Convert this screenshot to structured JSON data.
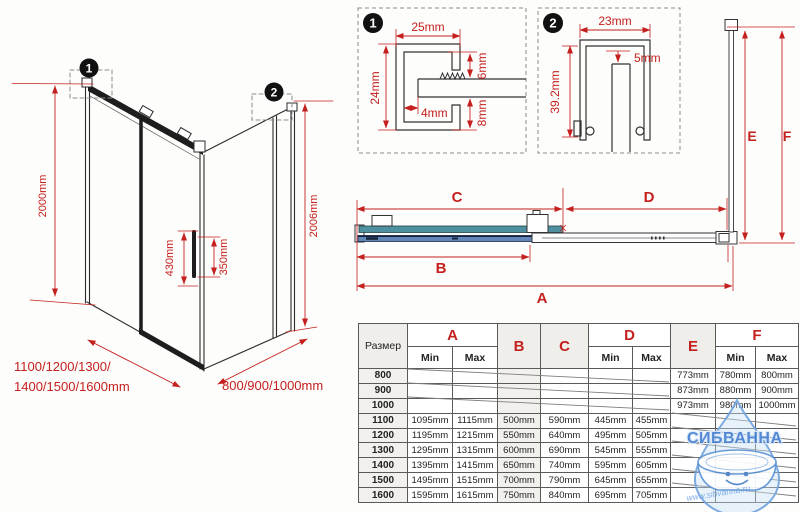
{
  "colors": {
    "dim_red": "#c4201d",
    "door_teal": "#4e8fa0",
    "panel_blue": "#6286b8",
    "edge_navy": "#1e2f4a",
    "watermark_blue": "#4780d2"
  },
  "iso": {
    "badge1": "1",
    "badge2": "2",
    "height_left": "2000mm",
    "height_right": "2006mm",
    "handle_outer": "430mm",
    "handle_inner": "350mm",
    "width_line1": "1100/1200/1300/",
    "width_line2": "1400/1500/1600mm",
    "depth": "800/900/1000mm"
  },
  "detail1": {
    "badge": "1",
    "width": "25mm",
    "height": "24mm",
    "top_gap": "6mm",
    "inset": "4mm",
    "bottom_gap": "8mm"
  },
  "detail2": {
    "badge": "2",
    "width": "23mm",
    "gap": "5mm",
    "height": "39.2mm"
  },
  "topview": {
    "a": "A",
    "b": "B",
    "c": "C",
    "d": "D",
    "e": "E",
    "f": "F"
  },
  "table": {
    "size_header": "Размер",
    "min": "Min",
    "max": "Max",
    "col_a": "A",
    "col_b": "B",
    "col_c": "C",
    "col_d": "D",
    "col_e": "E",
    "col_f": "F",
    "rows": [
      {
        "size": "800",
        "a_min": "",
        "a_max": "",
        "b": "",
        "c": "",
        "d_min": "",
        "d_max": "",
        "e": "773mm",
        "f_min": "780mm",
        "f_max": "800mm"
      },
      {
        "size": "900",
        "a_min": "",
        "a_max": "",
        "b": "",
        "c": "",
        "d_min": "",
        "d_max": "",
        "e": "873mm",
        "f_min": "880mm",
        "f_max": "900mm"
      },
      {
        "size": "1000",
        "a_min": "",
        "a_max": "",
        "b": "",
        "c": "",
        "d_min": "",
        "d_max": "",
        "e": "973mm",
        "f_min": "980mm",
        "f_max": "1000mm"
      },
      {
        "size": "1100",
        "a_min": "1095mm",
        "a_max": "1115mm",
        "b": "500mm",
        "c": "590mm",
        "d_min": "445mm",
        "d_max": "455mm",
        "e": "",
        "f_min": "",
        "f_max": ""
      },
      {
        "size": "1200",
        "a_min": "1195mm",
        "a_max": "1215mm",
        "b": "550mm",
        "c": "640mm",
        "d_min": "495mm",
        "d_max": "505mm",
        "e": "",
        "f_min": "",
        "f_max": ""
      },
      {
        "size": "1300",
        "a_min": "1295mm",
        "a_max": "1315mm",
        "b": "600mm",
        "c": "690mm",
        "d_min": "545mm",
        "d_max": "555mm",
        "e": "",
        "f_min": "",
        "f_max": ""
      },
      {
        "size": "1400",
        "a_min": "1395mm",
        "a_max": "1415mm",
        "b": "650mm",
        "c": "740mm",
        "d_min": "595mm",
        "d_max": "605mm",
        "e": "",
        "f_min": "",
        "f_max": ""
      },
      {
        "size": "1500",
        "a_min": "1495mm",
        "a_max": "1515mm",
        "b": "700mm",
        "c": "790mm",
        "d_min": "645mm",
        "d_max": "655mm",
        "e": "",
        "f_min": "",
        "f_max": ""
      },
      {
        "size": "1600",
        "a_min": "1595mm",
        "a_max": "1615mm",
        "b": "750mm",
        "c": "840mm",
        "d_min": "695mm",
        "d_max": "705mm",
        "e": "",
        "f_min": "",
        "f_max": ""
      }
    ]
  },
  "watermark": {
    "brand": "СИБВАННА",
    "url": "www.sibvanna.ru"
  }
}
